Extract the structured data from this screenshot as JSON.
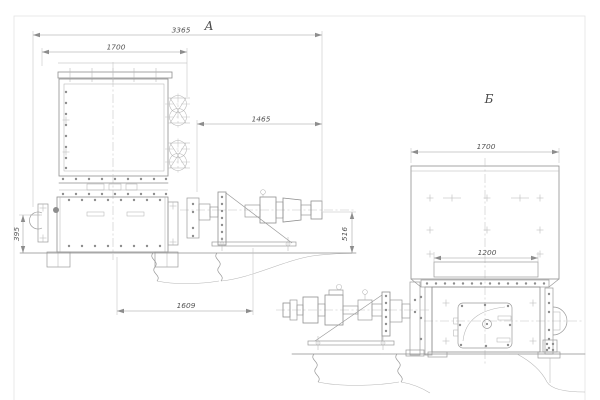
{
  "drawing": {
    "view_labels": {
      "a": "А",
      "b": "Б"
    },
    "dims": {
      "overall_width": "3365",
      "top_box_width": "1700",
      "drive_span": "1465",
      "left_flange_height": "395",
      "base_span": "1609",
      "drive_axis_height": "516",
      "hopper_width": "1700",
      "outlet_width": "1200"
    }
  }
}
